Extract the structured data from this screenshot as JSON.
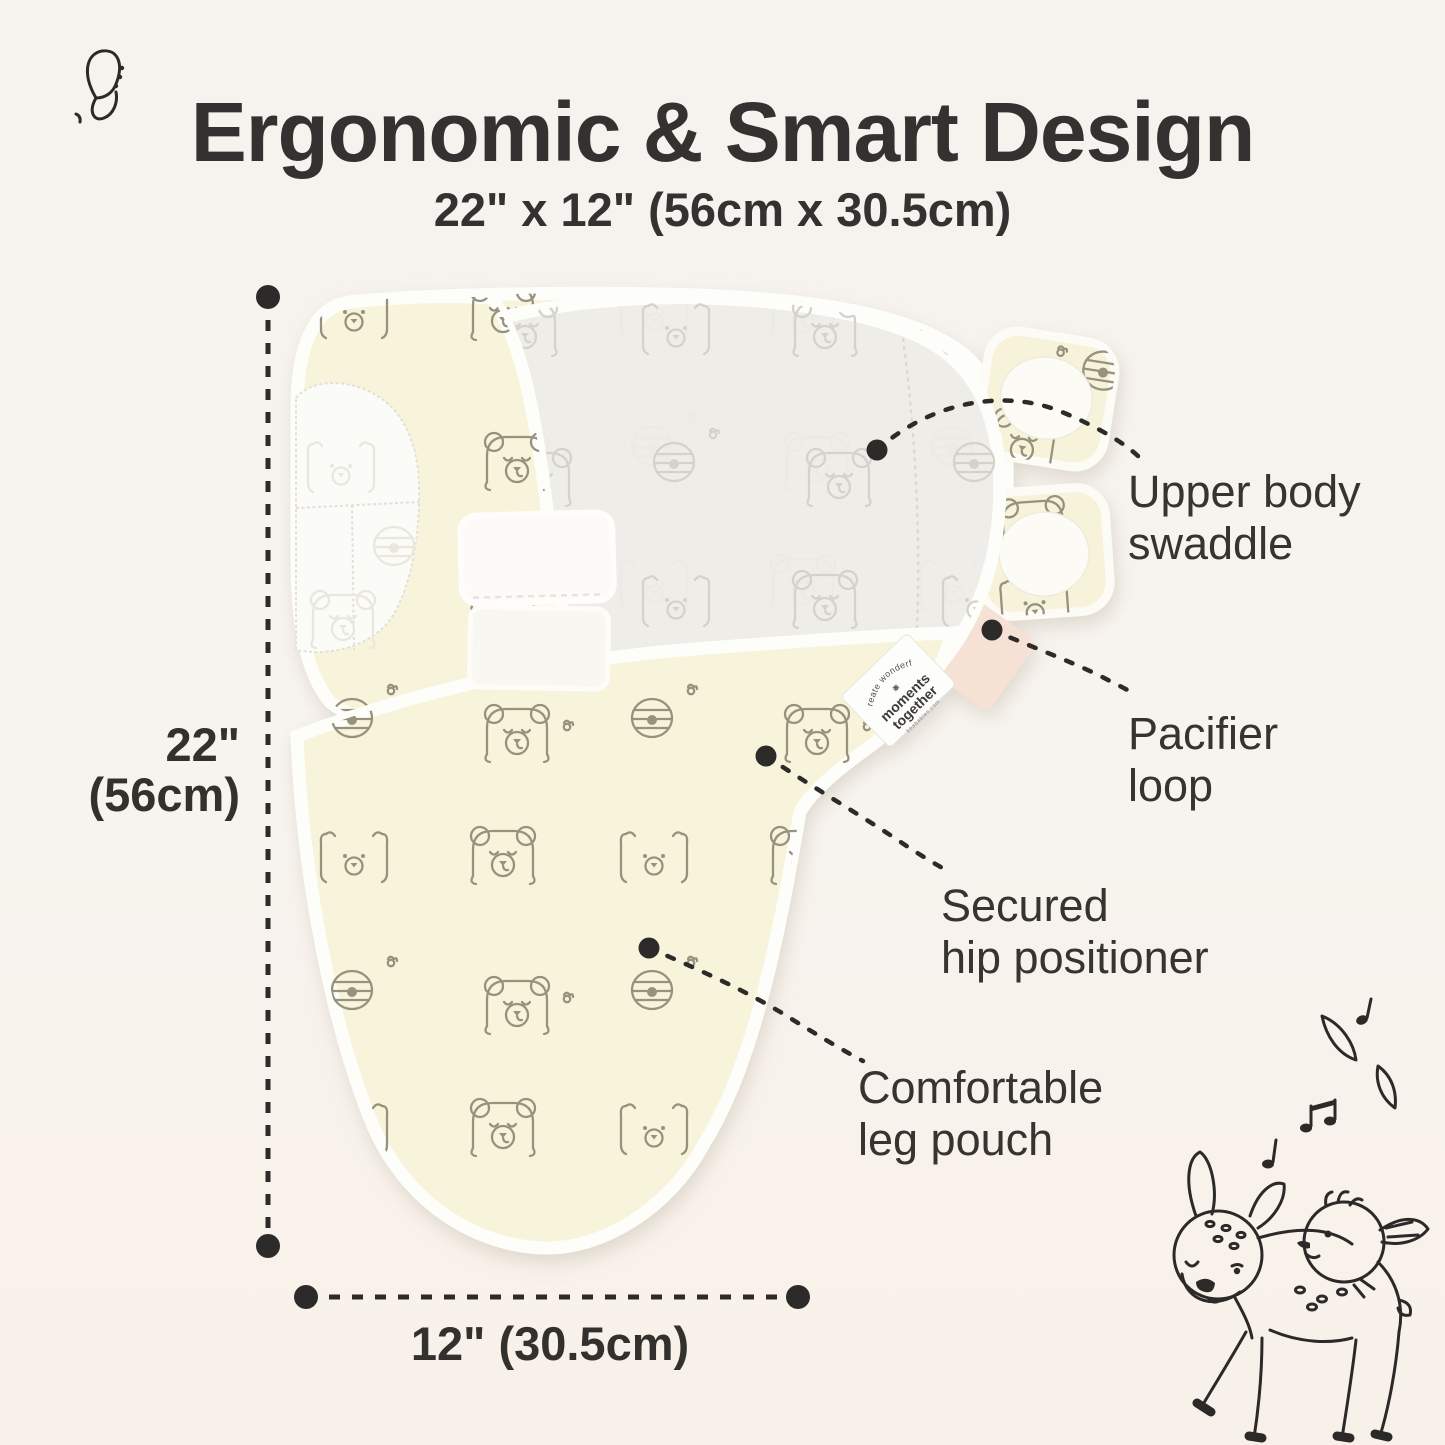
{
  "page": {
    "background": "#f7f3ee",
    "text_color": "#33312e",
    "accent_colors": {
      "fabric_cream": "#f8f4db",
      "fabric_gray": "#edece8",
      "binding_white": "#fdfdfa",
      "pacifier_tab_pink": "#f6e1d5",
      "annotation_dark": "#2c2b29"
    }
  },
  "header": {
    "title": "Ergonomic & Smart Design",
    "subtitle": "22\" x 12\" (56cm x 30.5cm)"
  },
  "dimensions": {
    "height": {
      "value": "22\"",
      "metric": "(56cm)"
    },
    "width": {
      "value": "12\" (30.5cm)"
    }
  },
  "callouts": {
    "upper_body": {
      "line1": "Upper body",
      "line2": "swaddle"
    },
    "pacifier": {
      "line1": "Pacifier",
      "line2": "loop"
    },
    "hip": {
      "line1": "Secured",
      "line2": "hip positioner"
    },
    "leg": {
      "line1": "Comfortable",
      "line2": "leg pouch"
    }
  },
  "product_tag": {
    "arc_text": "create wonderful",
    "brand_line1": "moments",
    "brand_line2": "together",
    "website": "keababies.com"
  },
  "decorations": {
    "top_left": "butterfly-icon",
    "bottom_right": "deer-and-bird-illustration",
    "floating": "music-notes-and-leaves"
  }
}
